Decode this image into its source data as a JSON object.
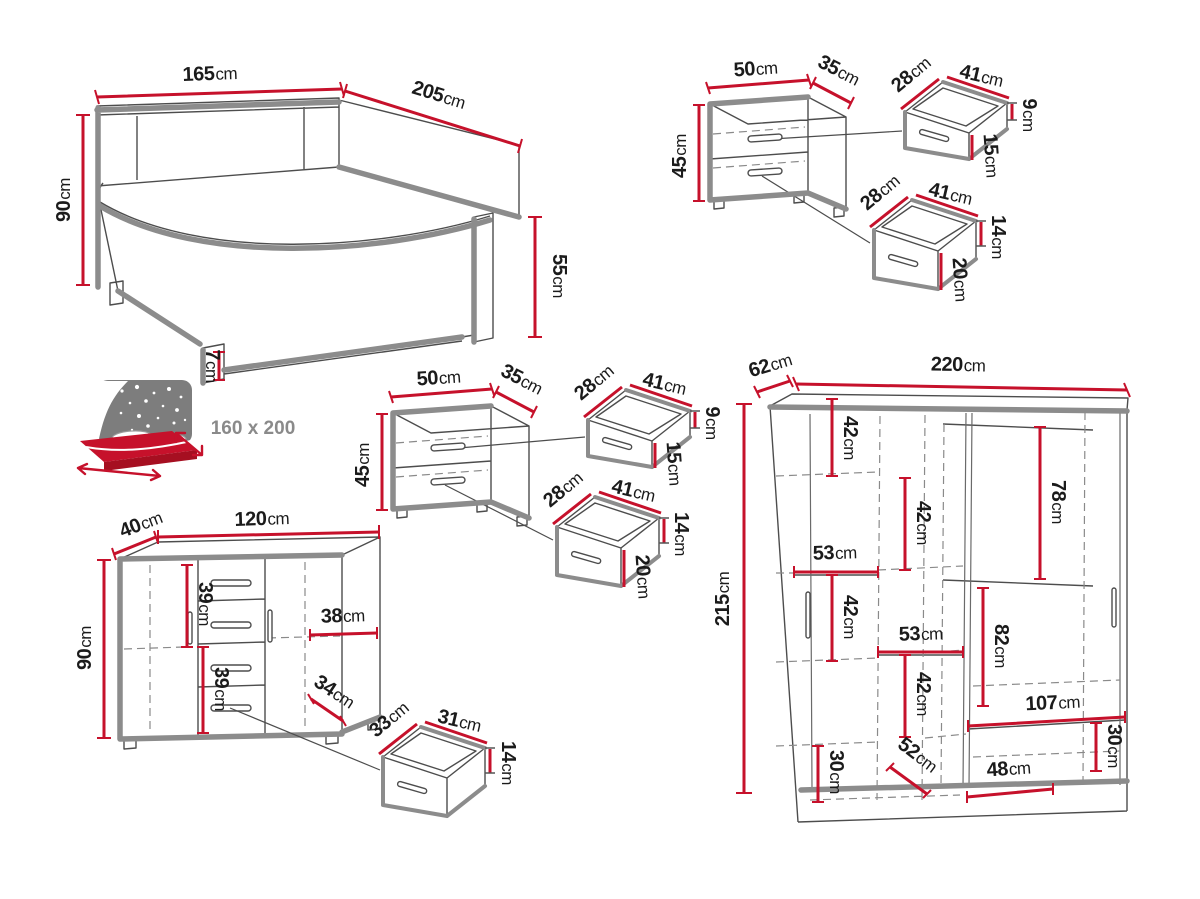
{
  "colors": {
    "dimension_red": "#c6112b",
    "outline_gray": "#8c8c8c",
    "detail_dark": "#4d4d4d",
    "label_text": "#1b1b1b",
    "icon_gray": "#7d7d7d",
    "size_text_gray": "#8a8a8a"
  },
  "bed": {
    "width": {
      "v": "165",
      "u": "cm"
    },
    "length": {
      "v": "205",
      "u": "cm"
    },
    "headboard_height": {
      "v": "90",
      "u": "cm"
    },
    "footboard_height": {
      "v": "55",
      "u": "cm"
    },
    "leg_height": {
      "v": "7",
      "u": "cm"
    },
    "mattress_size": {
      "v": "160 x 200",
      "u": ""
    }
  },
  "nightstand_top": {
    "width": {
      "v": "50",
      "u": "cm"
    },
    "depth": {
      "v": "35",
      "u": "cm"
    },
    "height": {
      "v": "45",
      "u": "cm"
    },
    "top_drawer": {
      "depth": {
        "v": "28",
        "u": "cm"
      },
      "width": {
        "v": "41",
        "u": "cm"
      },
      "back_height": {
        "v": "9",
        "u": "cm"
      },
      "front_height": {
        "v": "15",
        "u": "cm"
      }
    },
    "bottom_drawer": {
      "depth": {
        "v": "28",
        "u": "cm"
      },
      "width": {
        "v": "41",
        "u": "cm"
      },
      "back_height": {
        "v": "14",
        "u": "cm"
      },
      "front_height": {
        "v": "20",
        "u": "cm"
      }
    }
  },
  "nightstand_middle": {
    "width": {
      "v": "50",
      "u": "cm"
    },
    "depth": {
      "v": "35",
      "u": "cm"
    },
    "height": {
      "v": "45",
      "u": "cm"
    },
    "top_drawer": {
      "depth": {
        "v": "28",
        "u": "cm"
      },
      "width": {
        "v": "41",
        "u": "cm"
      },
      "back_height": {
        "v": "9",
        "u": "cm"
      },
      "front_height": {
        "v": "15",
        "u": "cm"
      }
    },
    "bottom_drawer": {
      "depth": {
        "v": "28",
        "u": "cm"
      },
      "width": {
        "v": "41",
        "u": "cm"
      },
      "back_height": {
        "v": "14",
        "u": "cm"
      },
      "front_height": {
        "v": "20",
        "u": "cm"
      }
    }
  },
  "dresser": {
    "depth": {
      "v": "40",
      "u": "cm"
    },
    "width": {
      "v": "120",
      "u": "cm"
    },
    "height": {
      "v": "90",
      "u": "cm"
    },
    "upper_inner_height": {
      "v": "39",
      "u": "cm"
    },
    "lower_inner_height": {
      "v": "39",
      "u": "cm"
    },
    "right_inner_width": {
      "v": "38",
      "u": "cm"
    },
    "drawer_opening_width": {
      "v": "34",
      "u": "cm"
    },
    "drawer": {
      "depth": {
        "v": "33",
        "u": "cm"
      },
      "width": {
        "v": "31",
        "u": "cm"
      },
      "height": {
        "v": "14",
        "u": "cm"
      }
    }
  },
  "wardrobe": {
    "depth": {
      "v": "62",
      "u": "cm"
    },
    "width": {
      "v": "220",
      "u": "cm"
    },
    "height": {
      "v": "215",
      "u": "cm"
    },
    "sections": {
      "top_left": {
        "v": "42",
        "u": "cm"
      },
      "upper_middle": {
        "v": "42",
        "u": "cm"
      },
      "left_shelf": {
        "v": "53",
        "u": "cm"
      },
      "middle_left": {
        "v": "42",
        "u": "cm"
      },
      "middle_shelf": {
        "v": "53",
        "u": "cm"
      },
      "lower_middle": {
        "v": "42",
        "u": "cm"
      },
      "right_upper": {
        "v": "78",
        "u": "cm"
      },
      "right_middle": {
        "v": "82",
        "u": "cm"
      },
      "bottom_shelf": {
        "v": "107",
        "u": "cm"
      },
      "bottom_right": {
        "v": "30",
        "u": "cm"
      },
      "bottom_left": {
        "v": "30",
        "u": "cm"
      },
      "bottom_diagonal": {
        "v": "52",
        "u": "cm"
      },
      "bottom_width": {
        "v": "48",
        "u": "cm"
      }
    }
  }
}
